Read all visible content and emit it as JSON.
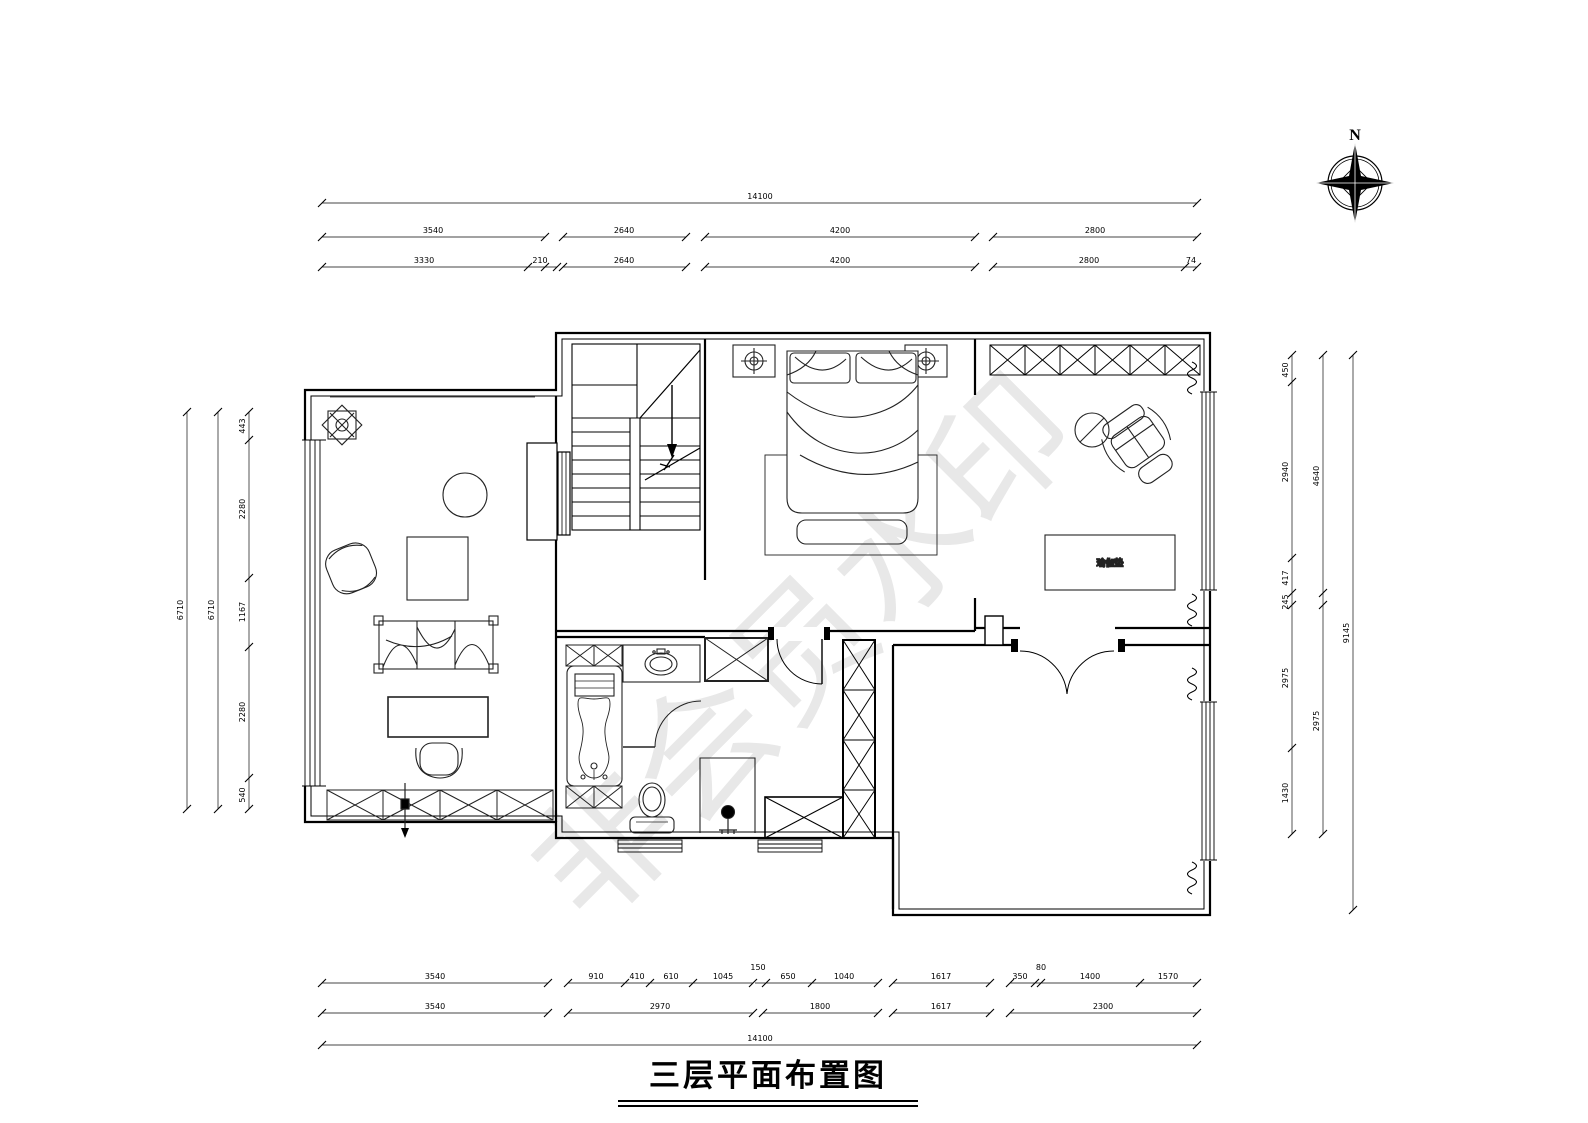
{
  "page": {
    "background": "#ffffff",
    "line_color": "#000000",
    "watermark_color": "#e8e8e8"
  },
  "title_block": {
    "text": "三层平面布置图"
  },
  "compass": {
    "label": "N"
  },
  "watermark": {
    "text": "非会员水印"
  },
  "plan": {
    "room_item_label": "瑜伽垫"
  },
  "dims": {
    "top_total": "14100",
    "top_row2": [
      "3540",
      "2640",
      "4200",
      "2800"
    ],
    "top_row3": [
      "3330",
      "210",
      "2640",
      "4200",
      "2800",
      "74"
    ],
    "bottom_row1": [
      "3540",
      "910",
      "410",
      "610",
      "1045",
      "150",
      "650",
      "1040",
      "1617",
      "350",
      "80",
      "1400",
      "1570"
    ],
    "bottom_row2": [
      "3540",
      "2970",
      "1800",
      "1617",
      "2300"
    ],
    "bottom_total": "14100",
    "left_outer": "6710",
    "left_mid": "6710",
    "left_inner": [
      "443",
      "2280",
      "1167",
      "2280",
      "540"
    ],
    "right_inner": [
      "450",
      "2940",
      "417",
      "245",
      "2975",
      "1430"
    ],
    "right_mid": [
      "4640",
      "2975"
    ],
    "right_outer": "9145"
  }
}
